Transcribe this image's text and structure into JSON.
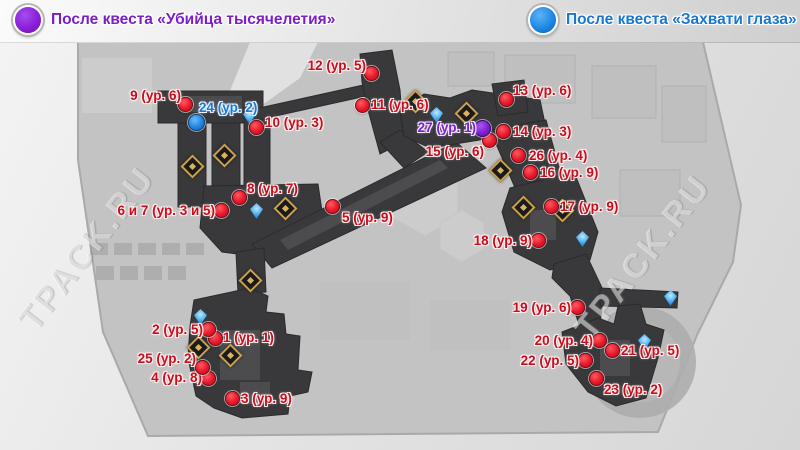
{
  "legend": [
    {
      "id": "after-quest-millennium-killer",
      "label": "После квеста «Убийца тысячелетия»",
      "color": "#8a1fd6",
      "text_color": "#7a1ec8"
    },
    {
      "id": "after-quest-capture-eyes",
      "label": "После квеста «Захвати глаза»",
      "color": "#1e88e5",
      "text_color": "#1877d2"
    }
  ],
  "watermark": {
    "text": "TPACK.RU"
  },
  "colors": {
    "marker_red": "#e8172b",
    "marker_blue": "#1e86e0",
    "marker_purple": "#7c1fd0",
    "label_red": "#c60f1e",
    "map_dark": "#39393b",
    "district_gray": "#c3c3c3",
    "chest_gold": "#c9a24b",
    "teleport_blue": "#4fb0f2"
  },
  "markers": [
    {
      "num": "1",
      "level": "ур. 1",
      "label": "1 (ур. 1)",
      "kind": "red",
      "x": 216,
      "y": 339,
      "lx": 223,
      "ly": 338,
      "align": "left"
    },
    {
      "num": "2",
      "level": "ур. 5",
      "label": "2 (ур. 5)",
      "kind": "red",
      "x": 209,
      "y": 330,
      "lx": 203,
      "ly": 330,
      "align": "right"
    },
    {
      "num": "3",
      "level": "ур. 9",
      "label": "3 (ур. 9)",
      "kind": "red",
      "x": 233,
      "y": 399,
      "lx": 241,
      "ly": 399,
      "align": "left"
    },
    {
      "num": "4",
      "level": "ур. 8",
      "label": "4 (ур. 8)",
      "kind": "red",
      "x": 209,
      "y": 379,
      "lx": 202,
      "ly": 378,
      "align": "right"
    },
    {
      "num": "5",
      "level": "ур. 9",
      "label": "5 (ур. 9)",
      "kind": "red",
      "x": 333,
      "y": 207,
      "lx": 342,
      "ly": 218,
      "align": "left"
    },
    {
      "num": "6 и 7",
      "level": "ур. 3 и 5",
      "label": "6 и 7 (ур. 3 и 5)",
      "kind": "red",
      "x": 222,
      "y": 211,
      "lx": 215,
      "ly": 211,
      "align": "right"
    },
    {
      "num": "8",
      "level": "ур. 7",
      "label": "8 (ур. 7)",
      "kind": "red",
      "x": 240,
      "y": 198,
      "lx": 247,
      "ly": 189,
      "align": "left"
    },
    {
      "num": "9",
      "level": "ур. 6",
      "label": "9 (ур. 6)",
      "kind": "red",
      "x": 186,
      "y": 105,
      "lx": 181,
      "ly": 96,
      "align": "right"
    },
    {
      "num": "10",
      "level": "ур. 3",
      "label": "10 (ур. 3)",
      "kind": "red",
      "x": 257,
      "y": 128,
      "lx": 265,
      "ly": 123,
      "align": "left"
    },
    {
      "num": "11",
      "level": "ур. 6",
      "label": "11 (ур. 6)",
      "kind": "red",
      "x": 363,
      "y": 106,
      "lx": 371,
      "ly": 105,
      "align": "left"
    },
    {
      "num": "12",
      "level": "ур. 5",
      "label": "12 (ур. 5)",
      "kind": "red",
      "x": 372,
      "y": 74,
      "lx": 366,
      "ly": 66,
      "align": "right"
    },
    {
      "num": "13",
      "level": "ур. 6",
      "label": "13 (ур. 6)",
      "kind": "red",
      "x": 507,
      "y": 100,
      "lx": 513,
      "ly": 91,
      "align": "left"
    },
    {
      "num": "14",
      "level": "ур. 3",
      "label": "14 (ур. 3)",
      "kind": "red",
      "x": 504,
      "y": 132,
      "lx": 513,
      "ly": 132,
      "align": "left"
    },
    {
      "num": "15",
      "level": "ур. 6",
      "label": "15 (ур. 6)",
      "kind": "red",
      "x": 490,
      "y": 141,
      "lx": 484,
      "ly": 152,
      "align": "right"
    },
    {
      "num": "16",
      "level": "ур. 9",
      "label": "16 (ур. 9)",
      "kind": "red",
      "x": 531,
      "y": 173,
      "lx": 540,
      "ly": 173,
      "align": "left"
    },
    {
      "num": "17",
      "level": "ур. 9",
      "label": "17 (ур. 9)",
      "kind": "red",
      "x": 552,
      "y": 207,
      "lx": 560,
      "ly": 207,
      "align": "left"
    },
    {
      "num": "18",
      "level": "ур. 9",
      "label": "18 (ур. 9)",
      "kind": "red",
      "x": 539,
      "y": 241,
      "lx": 532,
      "ly": 241,
      "align": "right"
    },
    {
      "num": "19",
      "level": "ур. 6",
      "label": "19 (ур. 6)",
      "kind": "red",
      "x": 578,
      "y": 308,
      "lx": 571,
      "ly": 308,
      "align": "right"
    },
    {
      "num": "20",
      "level": "ур. 4",
      "label": "20 (ур. 4)",
      "kind": "red",
      "x": 600,
      "y": 341,
      "lx": 593,
      "ly": 341,
      "align": "right"
    },
    {
      "num": "21",
      "level": "ур. 5",
      "label": "21 (ур. 5)",
      "kind": "red",
      "x": 613,
      "y": 351,
      "lx": 621,
      "ly": 351,
      "align": "left"
    },
    {
      "num": "22",
      "level": "ур. 5",
      "label": "22 (ур. 5)",
      "kind": "red",
      "x": 586,
      "y": 361,
      "lx": 579,
      "ly": 361,
      "align": "right"
    },
    {
      "num": "23",
      "level": "ур. 2",
      "label": "23 (ур. 2)",
      "kind": "red",
      "x": 597,
      "y": 379,
      "lx": 604,
      "ly": 390,
      "align": "left"
    },
    {
      "num": "24",
      "level": "ур. 2",
      "label": "24 (ур. 2)",
      "kind": "blue",
      "x": 197,
      "y": 123,
      "lx": 199,
      "ly": 108,
      "align": "left"
    },
    {
      "num": "25",
      "level": "ур. 2",
      "label": "25 (ур. 2)",
      "kind": "red",
      "x": 203,
      "y": 368,
      "lx": 196,
      "ly": 359,
      "align": "right"
    },
    {
      "num": "26",
      "level": "ур. 4",
      "label": "26 (ур. 4)",
      "kind": "red",
      "x": 519,
      "y": 156,
      "lx": 529,
      "ly": 156,
      "align": "left"
    },
    {
      "num": "27",
      "level": "ур. 1",
      "label": "27 (ур. 1)",
      "kind": "purple",
      "x": 483,
      "y": 129,
      "lx": 476,
      "ly": 128,
      "align": "right"
    }
  ],
  "chests": [
    {
      "x": 192,
      "y": 166
    },
    {
      "x": 224,
      "y": 155
    },
    {
      "x": 285,
      "y": 208
    },
    {
      "x": 250,
      "y": 280
    },
    {
      "x": 230,
      "y": 355
    },
    {
      "x": 198,
      "y": 347
    },
    {
      "x": 415,
      "y": 101
    },
    {
      "x": 466,
      "y": 113
    },
    {
      "x": 500,
      "y": 170
    },
    {
      "x": 523,
      "y": 207
    },
    {
      "x": 562,
      "y": 210
    }
  ],
  "teleports": [
    {
      "x": 249,
      "y": 116
    },
    {
      "x": 436,
      "y": 115
    },
    {
      "x": 256,
      "y": 211
    },
    {
      "x": 200,
      "y": 317
    },
    {
      "x": 582,
      "y": 239
    },
    {
      "x": 670,
      "y": 298
    },
    {
      "x": 644,
      "y": 342
    }
  ]
}
